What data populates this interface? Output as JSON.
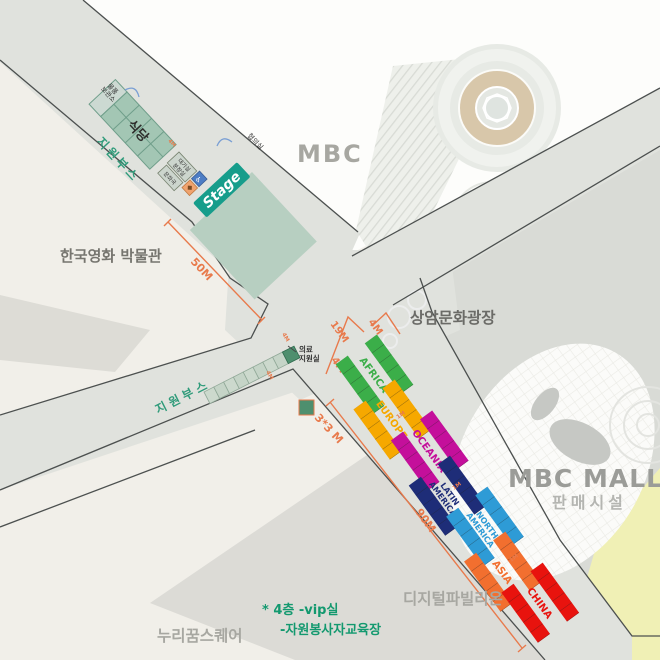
{
  "title": "행사장 배치도 (event site map)",
  "places": {
    "mbc": "MBC",
    "museum": "한국영화 박물관",
    "plaza": "상암문화광장",
    "mall": "MBC MALL",
    "mall_sub": "판매시설",
    "pavilion": "디지털파빌리온",
    "nuri": "누리꿈스퀘어"
  },
  "stage_area": {
    "stage": "Stage",
    "restaurant": "식당",
    "storage_line1": "물품",
    "storage_line2": "보관소",
    "meeting_room": "협의실",
    "waiting_room": "대기실",
    "dressing_room": "분장실",
    "bureau_room": "문화국",
    "support_booth_top": "지원부스",
    "support_booth_mid": "지원부스",
    "medical_line1": "의료",
    "medical_line2": "지원실"
  },
  "notes": {
    "note_line1": "* 4층 -vip실",
    "note_line2": "-자원봉사자교육장"
  },
  "dimensions": {
    "top_road": "50M",
    "road_width": "19M",
    "booth_width_a": "4M",
    "booth_width_b": "4M",
    "booth_width_small_a": "4M",
    "booth_width_small_b": "4M",
    "stage_mark": "4M",
    "right_road": "90M",
    "booth_size": "3*3 M",
    "gap": "1M"
  },
  "booths": [
    {
      "line1": "AFRICA",
      "line2": "",
      "color": "#3bae49"
    },
    {
      "line1": "EUROPE",
      "line2": "",
      "color": "#f6a800"
    },
    {
      "line1": "OCEANIA",
      "line2": "",
      "color": "#c40f9b"
    },
    {
      "line1": "LATIN",
      "line2": "AMERICA",
      "color": "#1e2d78"
    },
    {
      "line1": "NORTH",
      "line2": "AMERICA",
      "color": "#2e9bd6"
    },
    {
      "line1": "ASIA",
      "line2": "",
      "color": "#f26f2f"
    },
    {
      "line1": "CHINA",
      "line2": "",
      "color": "#e8130e"
    }
  ],
  "colors": {
    "road": "#e0e2dd",
    "plaza": "#d9dbd6",
    "ground": "#f1efe9",
    "white_block": "#fdfdfb",
    "grass_yellow": "#f0f0b5",
    "border_line": "#4c504f",
    "dimension_orange": "#e87a4c",
    "stage_teal": "#169d8b",
    "booth_cell_teal": "#a3c6b4",
    "medical_green": "#4e8f6e",
    "note_green": "#13996f"
  }
}
